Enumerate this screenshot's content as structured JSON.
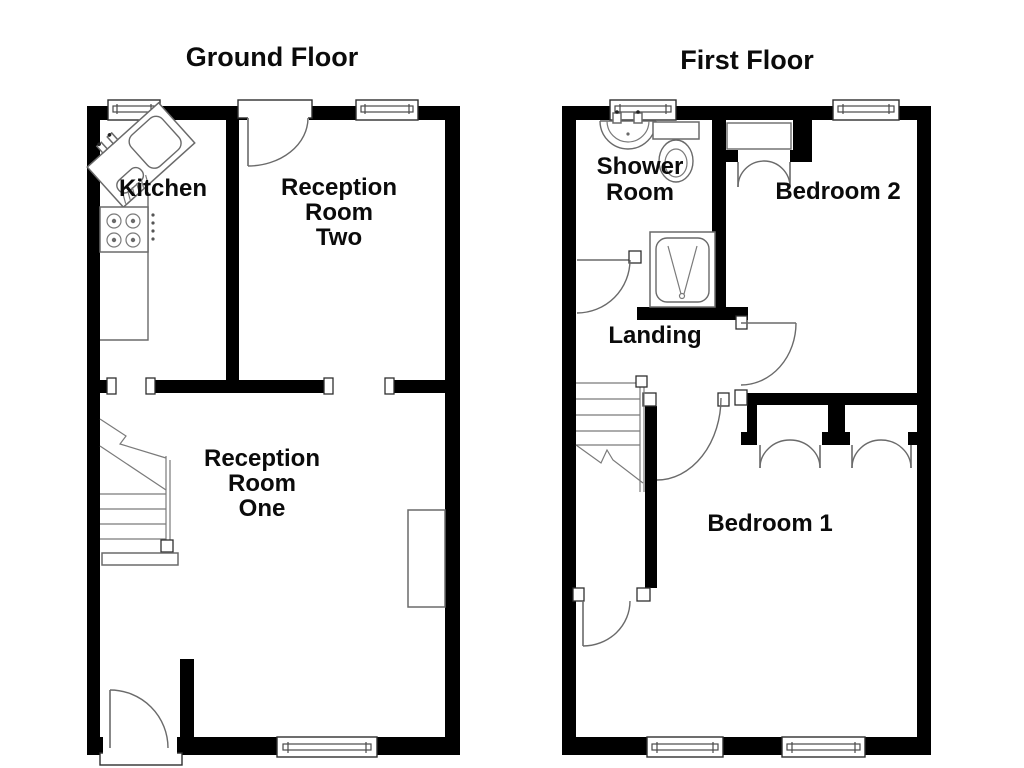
{
  "canvas": {
    "background": "#ffffff",
    "ink": "#000000"
  },
  "ground": {
    "title": "Ground Floor",
    "labels": {
      "kitchen": "Kitchen",
      "reception_two": [
        "Reception",
        "Room",
        "Two"
      ],
      "reception_one": [
        "Reception",
        "Room",
        "One"
      ]
    },
    "fixture_icons": [
      "sink-drainer-icon",
      "hob-icon",
      "staircase-up-icon",
      "front-door-icon",
      "rear-door-icon",
      "window-icon",
      "fitted-unit-icon"
    ]
  },
  "first": {
    "title": "First Floor",
    "labels": {
      "shower_room": [
        "Shower",
        "Room"
      ],
      "bedroom_2": "Bedroom 2",
      "landing": "Landing",
      "bedroom_1": "Bedroom 1"
    },
    "fixture_icons": [
      "wash-basin-icon",
      "toilet-icon",
      "shower-cubicle-icon",
      "staircase-down-icon",
      "cupboard-doors-icon",
      "wardrobe-doors-icon",
      "window-icon"
    ]
  }
}
